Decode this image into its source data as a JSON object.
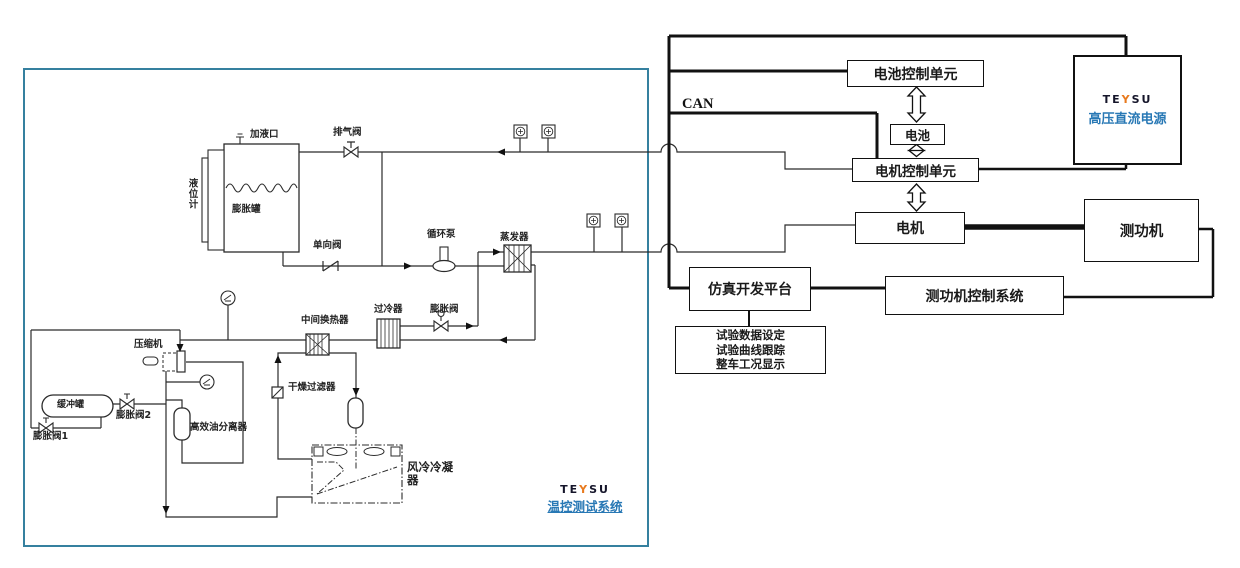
{
  "brand": {
    "pre": "TE",
    "mid": "Y",
    "post": "SU"
  },
  "colors": {
    "accent_blue": "#2878b5",
    "panel_border": "#35809f",
    "brand_orange": "#e87a1e",
    "line": "#111111"
  },
  "left_panel": {
    "system_title": "温控测试系统",
    "labels": {
      "fill_port": "加液口",
      "exhaust_valve": "排气阀",
      "level_gauge": "液位计",
      "expansion_tank": "膨胀罐",
      "check_valve": "单向阀",
      "circulation_pump": "循环泵",
      "evaporator": "蒸发器",
      "intermediate_hx": "中间换热器",
      "subcooler": "过冷器",
      "expansion_valve": "膨胀阀",
      "dryer_filter": "干燥过滤器",
      "compressor": "压缩机",
      "buffer_tank": "缓冲罐",
      "expansion_valve_1": "膨胀阀1",
      "expansion_valve_2": "膨胀阀2",
      "oil_separator": "高效油分离器",
      "air_cooled_condenser": "风冷冷凝器"
    }
  },
  "right_panel": {
    "bus_label": "CAN",
    "blocks": {
      "battery_control_unit": "电池控制单元",
      "battery": "电池",
      "motor_control_unit": "电机控制单元",
      "motor": "电机",
      "dynamometer": "测功机",
      "dynamometer_control_system": "测功机控制系统",
      "simulation_platform": "仿真开发平台"
    },
    "power_supply_title": "高压直流电源",
    "info_lines": [
      "试验数据设定",
      "试验曲线跟踪",
      "整车工况显示"
    ]
  }
}
